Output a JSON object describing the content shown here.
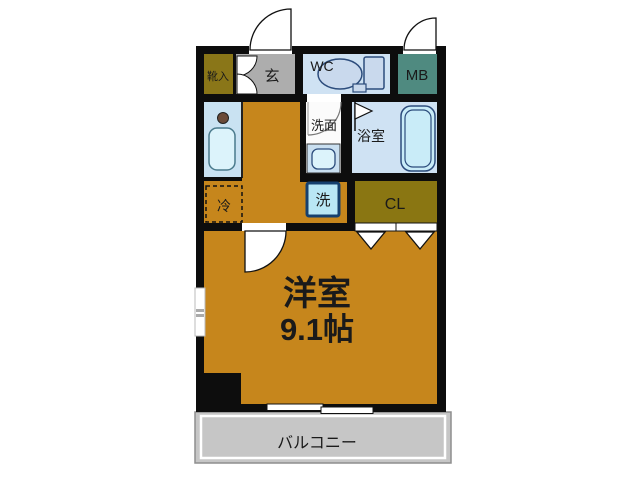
{
  "floorplan": {
    "labels": {
      "shoe_box": "靴入",
      "entrance": "玄",
      "wc": "WC",
      "meter_box": "MB",
      "washroom": "洗面",
      "bathroom": "浴室",
      "fridge": "冷",
      "washer": "洗",
      "closet": "CL",
      "room_name": "洋室",
      "room_size": "9.1帖",
      "balcony": "バルコニー"
    },
    "colors": {
      "wall": "#0d0d0d",
      "room_orange": "#c6861c",
      "shoe_olive": "#8a7618",
      "closet_olive": "#8a7612",
      "entrance_gray": "#adadad",
      "wc_blue": "#cfe2f3",
      "bath_blue": "#cfe2f3",
      "kitchen_blue": "#c9e2f2",
      "washroom_white": "#fbfbfb",
      "meter_teal": "#4f8a80",
      "washer_blue": "#b9e7f5",
      "fixture_fill": "#c9ecf8",
      "toilet_fill": "#c9d9ed",
      "sink_fill": "#dcf3fb",
      "balcony_gray": "#c6c6c6"
    }
  }
}
